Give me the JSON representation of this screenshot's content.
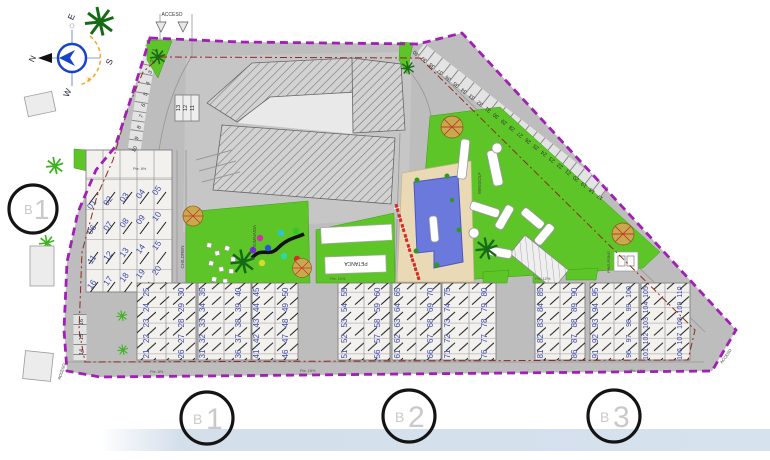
{
  "plan": {
    "access_labels": {
      "top": "ACCESO",
      "bottom_left": "ACCESO",
      "bottom_right": "ACCESO"
    },
    "compass": {
      "north": "N",
      "south": "S",
      "east": "E",
      "west": "W"
    },
    "amenities": {
      "children": "CHILDREN",
      "gimnasia": "GIMNASIA",
      "petanca": "PETANCA",
      "minigolf": "MINIGOLF",
      "ping_pong": "PING-PONG"
    },
    "slopes": {
      "s1": "Pte. 8%",
      "s2": "Pte. 8%",
      "s3": "Pte. 12%",
      "s4": "Pte. 12%",
      "s5": "Pte. 15%",
      "s6": "Pte. 15%"
    },
    "building_markers": {
      "left": {
        "prefix": "B",
        "number": "1"
      },
      "bottom": [
        {
          "prefix": "B",
          "number": "1"
        },
        {
          "prefix": "B",
          "number": "2"
        },
        {
          "prefix": "B",
          "number": "3"
        }
      ]
    },
    "parking": {
      "entry_curve": [
        "1",
        "2",
        "3",
        "4",
        "5",
        "6",
        "7",
        "8",
        "9",
        "10"
      ],
      "boxed_row": [
        "13",
        "12",
        "11"
      ],
      "west_edge": [
        "16",
        "15",
        "14"
      ],
      "northeast_edge": [
        "17",
        "18",
        "19",
        "20",
        "21",
        "22",
        "23",
        "24",
        "25",
        "26",
        "27",
        "28",
        "29",
        "30",
        "31",
        "32",
        "33",
        "34",
        "35",
        "36",
        "37",
        "38",
        "39",
        "40"
      ]
    },
    "units": {
      "upper_rows": [
        [
          "01",
          "02",
          "03",
          "04",
          "05"
        ],
        [
          "06",
          "07",
          "08",
          "09",
          "10"
        ],
        [
          "11",
          "12",
          "13",
          "14",
          "15"
        ],
        [
          "16",
          "17",
          "18",
          "19",
          "20"
        ]
      ],
      "south_columns": [
        [
          "21",
          "22",
          "23",
          "24",
          "25"
        ],
        [
          "26",
          "27",
          "28",
          "29",
          "30"
        ],
        [
          "31",
          "32",
          "33",
          "34",
          "35"
        ],
        [
          "36",
          "37",
          "38",
          "39",
          "40"
        ],
        [
          "41",
          "42",
          "43",
          "44",
          "45"
        ],
        [
          "46",
          "47",
          "48",
          "49",
          "50"
        ],
        [
          "51",
          "52",
          "53",
          "54",
          "55"
        ],
        [
          "56",
          "57",
          "58",
          "59",
          "60"
        ],
        [
          "61",
          "62",
          "63",
          "64",
          "65"
        ],
        [
          "66",
          "67",
          "68",
          "69",
          "70"
        ],
        [
          "71",
          "72",
          "73",
          "74",
          "75"
        ],
        [
          "76",
          "77",
          "78",
          "79",
          "80"
        ],
        [
          "81",
          "82",
          "83",
          "84",
          "85"
        ],
        [
          "86",
          "87",
          "88",
          "89",
          "90"
        ],
        [
          "91",
          "92",
          "93",
          "94",
          "95"
        ],
        [
          "96",
          "97",
          "98",
          "99",
          "100"
        ],
        [
          "101",
          "102",
          "103",
          "104",
          "105"
        ],
        [
          "106",
          "107",
          "108",
          "109",
          "110"
        ]
      ]
    },
    "colors": {
      "boundary": "#a21fb5",
      "setback_line": "#8d2b1e",
      "green": "#5ec528",
      "pool": "#6b79dd",
      "deck": "#ead9b5",
      "road": "#bdbdbd",
      "unit_number": "#3c49ae",
      "lounger_red": "#d62b20",
      "footer_band": "#ccd9e8"
    }
  }
}
